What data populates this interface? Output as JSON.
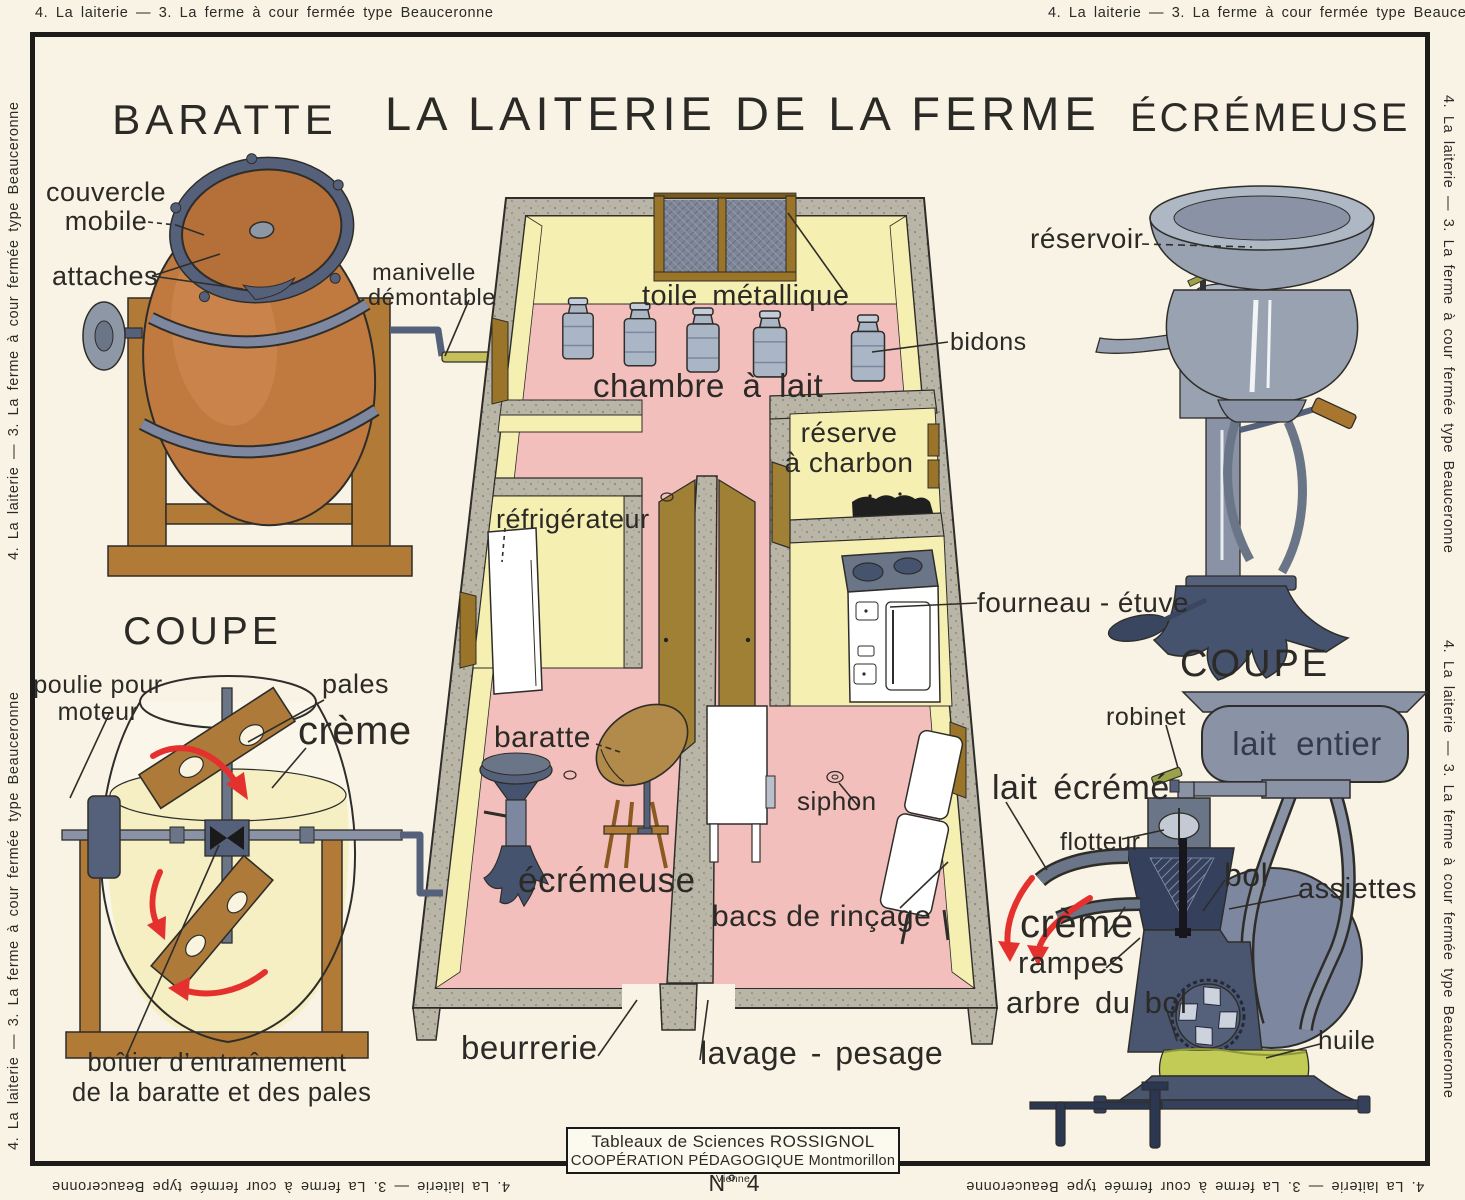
{
  "border_text": "4. La laiterie — 3. La ferme à cour fermée type Beauceronne",
  "main_title": "LA LAITERIE DE LA FERME",
  "baratte": {
    "title": "BARATTE",
    "couvercle_1": "couvercle",
    "couvercle_2": "mobile",
    "attaches": "attaches",
    "manivelle_1": "manivelle",
    "manivelle_2": "démontable"
  },
  "coupe_baratte": {
    "title": "COUPE",
    "poulie_1": "poulie pour",
    "poulie_2": "moteur",
    "pales": "pales",
    "creme": "crème",
    "boitier_1": "boîtier d’entraînement",
    "boitier_2": "de la baratte et des pales"
  },
  "plan": {
    "toile": "toile métallique",
    "bidons": "bidons",
    "chambre": "chambre à lait",
    "reserve_1": "réserve",
    "reserve_2": "à charbon",
    "refrigerateur": "réfrigérateur",
    "fourneau": "fourneau - étuve",
    "baratte": "baratte",
    "ecremeuse": "écrémeuse",
    "siphon": "siphon",
    "bacs": "bacs de rinçage",
    "beurrerie": "beurrerie",
    "lavage": "lavage - pesage"
  },
  "ecremeuse": {
    "title": "ÉCRÉMEUSE",
    "reservoir": "réservoir"
  },
  "coupe_ecremeuse": {
    "title": "COUPE",
    "robinet": "robinet",
    "lait_entier": "lait entier",
    "lait_ecreme": "lait écrémé",
    "flotteur": "flotteur",
    "bol": "bol",
    "assiettes": "assiettes",
    "creme": "crème",
    "rampes": "rampes",
    "arbre": "arbre du bol",
    "huile": "huile"
  },
  "footer": {
    "credit_1": "Tableaux de Sciences ROSSIGNOL",
    "credit_2": "COOPÉRATION PÉDAGOGIQUE",
    "credit_place": "Montmorillon",
    "credit_dept": "Vienne",
    "number": "N° 4"
  },
  "colors": {
    "background": "#f8f3e4",
    "frame": "#1d1c1a",
    "ink": "#2b2a26",
    "wall": "#b9b5a6",
    "wall_face": "#f6efb2",
    "floor": "#f3bfbc",
    "barrel": "#c0793f",
    "wood": "#b17a36",
    "door": "#a08035",
    "metal": "#8d97a6",
    "metal_dark": "#46536e",
    "navy": "#34405c",
    "cream": "#f5efc3",
    "red": "#e5312e",
    "oil": "#c2cb55",
    "crank": "#c5c05c"
  }
}
